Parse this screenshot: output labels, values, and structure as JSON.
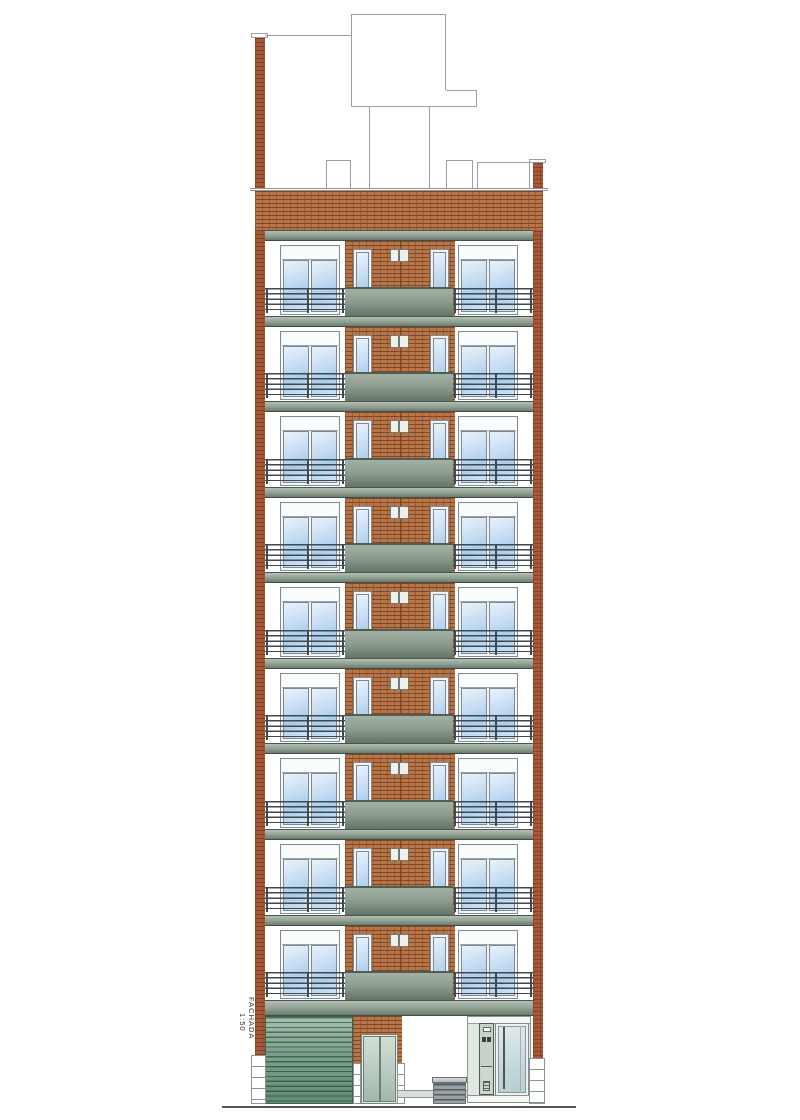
{
  "annotation": {
    "label": "FACHADA",
    "scale": "1:50"
  },
  "facade": {
    "floor_count": 9,
    "description": "residential building elevation, 9 typical floors over ground floor",
    "ground_floor": {
      "garage_door": "roller shutter",
      "entry_door": "double leaf",
      "entrance": "glass door with intercom panel",
      "street_furniture": "louvered bin"
    }
  },
  "colors": {
    "brick": "#b5774a",
    "pier_brick": "#a7593a",
    "slab_light": "#b3bfb4",
    "slab_dark": "#6b7d6f",
    "glass_light": "#e8f3fb",
    "glass_dark": "#a9cdec",
    "garage_green": "#628b74",
    "railing": "#3f4a50",
    "outline": "#9aa0a6",
    "ground": "#555555"
  }
}
